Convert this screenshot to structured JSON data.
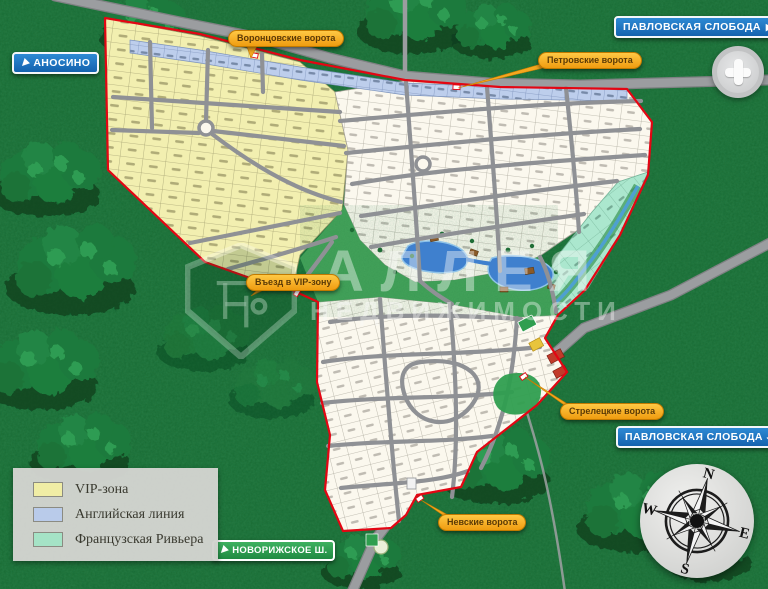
{
  "signs": {
    "anosino": {
      "text": "АНОСИНО",
      "direction": "sw"
    },
    "pavlovskaya_top": {
      "text": "ПАВЛОВСКАЯ СЛОБОДА",
      "direction": "e"
    },
    "pavlovskaya_right": {
      "text": "ПАВЛОВСКАЯ СЛОБОДА",
      "direction": "ne"
    },
    "novorizhskoe": {
      "text": "НОВОРИЖСКОЕ Ш.",
      "direction": "sw"
    }
  },
  "gates": {
    "vorontsovskie": {
      "text": "Воронцовские ворота"
    },
    "petrovskie": {
      "text": "Петровские ворота"
    },
    "streletskie": {
      "text": "Стрелецкие ворота"
    },
    "nevskie": {
      "text": "Невские ворота"
    },
    "vip_entrance": {
      "text": "Въезд в VIP-зону"
    }
  },
  "legend": {
    "items": [
      {
        "label": "VIP-зона",
        "color": "#F0EDA5"
      },
      {
        "label": "Английская линия",
        "color": "#B9CBEA"
      },
      {
        "label": "Французская Ривьера",
        "color": "#A5E3C6"
      }
    ]
  },
  "watermark": {
    "brand": "АЛЛЕЯ",
    "brand2": "НЕДВИЖИМОСТИ"
  },
  "compass": {
    "north": "N",
    "east": "E",
    "south": "S",
    "west": "W"
  },
  "zones": {
    "vip": {
      "color": "#F2EFB0",
      "visible_number_series": "400-е и 900-е номера участков"
    },
    "english_row": {
      "color": "#BDCEEC",
      "visible_number_series": "1500-е и 1600-е номера вдоль шоссе"
    },
    "french_riviera": {
      "color": "#ABE7CE",
      "visible_number_series": "800-е номера участков"
    },
    "standard_upper": {
      "color": "#FBF8EE",
      "visible_number_series": "400–700-е номера участков"
    },
    "standard_lower": {
      "color": "#FBF8EE",
      "visible_number_series": "100–300-е номера участков"
    }
  },
  "palette": {
    "forest": "#17682F",
    "road": "#97999C",
    "boundary": "#E30613",
    "park": "#44A35A",
    "water": "#3F80CE",
    "badge_orange": "#F6A623",
    "badge_blue": "#1B6FC0",
    "badge_green": "#2FA14D"
  }
}
